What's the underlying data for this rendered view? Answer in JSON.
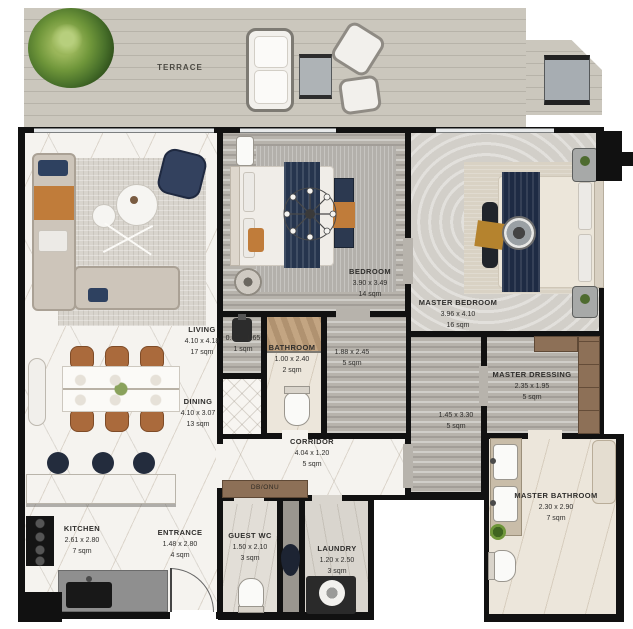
{
  "rooms": {
    "terrace": {
      "name": "TERRACE"
    },
    "living": {
      "name": "LIVING",
      "dims": "4.10 x 4.18",
      "area": "17 sqm"
    },
    "dining": {
      "name": "DINING",
      "dims": "4.10 x 3.07",
      "area": "13 sqm"
    },
    "bedroom": {
      "name": "BEDROOM",
      "dims": "3.90 x 3.49",
      "area": "14 sqm"
    },
    "closet": {
      "dims": "0.87 x 1.65",
      "area": "1 sqm"
    },
    "bathroom": {
      "name": "BATHROOM",
      "dims": "1.00 x 2.40",
      "area": "2 sqm"
    },
    "hall": {
      "dims": "1.88 x 2.45",
      "area": "5 sqm"
    },
    "master_bedroom": {
      "name": "MASTER BEDROOM",
      "dims": "3.96 x 4.10",
      "area": "16 sqm"
    },
    "master_hall": {
      "dims": "1.45 x 3.30",
      "area": "5 sqm"
    },
    "master_dressing": {
      "name": "MASTER DRESSING",
      "dims": "2.35 x 1.95",
      "area": "5 sqm"
    },
    "master_bathroom": {
      "name": "MASTER BATHROOM",
      "dims": "2.30 x 2.90",
      "area": "7 sqm"
    },
    "corridor": {
      "name": "CORRIDOR",
      "dims": "4.04 x 1.20",
      "area": "5 sqm"
    },
    "db_onu": {
      "name": "DB/ONU"
    },
    "guest_wc": {
      "name": "GUEST WC",
      "dims": "1.50 x 2.10",
      "area": "3 sqm"
    },
    "laundry": {
      "name": "LAUNDRY",
      "dims": "1.20 x 2.50",
      "area": "3 sqm"
    },
    "kitchen": {
      "name": "KITCHEN",
      "dims": "2.61 x 2.80",
      "area": "7 sqm"
    },
    "entrance": {
      "name": "ENTRANCE",
      "dims": "1.48 x 2.80",
      "area": "4 sqm"
    }
  },
  "colors": {
    "wall": "#111111",
    "deck": "#c9c4ba",
    "white_marble": "#f5f3ef",
    "gray_stone": "#b7b3ac",
    "beige_marble": "#ece6db",
    "navy_accent": "#2e4160",
    "orange_accent": "#c07c3a",
    "wood": "#8d7057"
  }
}
